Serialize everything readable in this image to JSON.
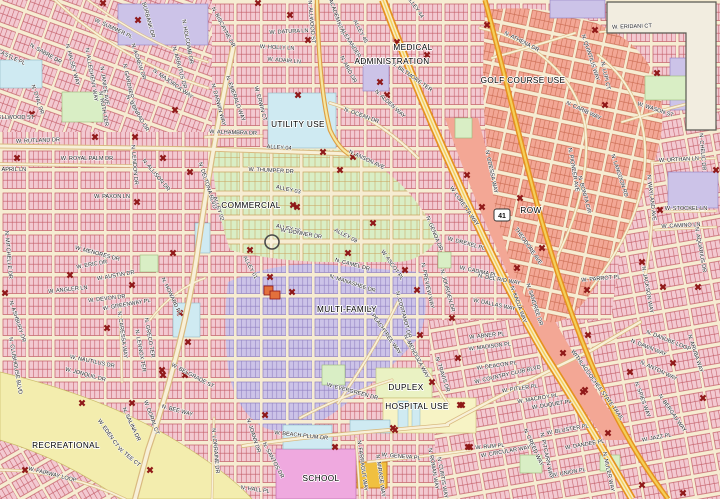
{
  "map": {
    "colors": {
      "parcel_pink": "#f3c9d1",
      "parcel_outline": "#c25b66",
      "street_cream": "#f6ecd2",
      "street_casing": "#d9ba80",
      "salmon": "#f3a795",
      "lavender": "#ccc3e8",
      "commercial_green": "#d9eec5",
      "utility_blue": "#cfeaf2",
      "recreation_yellow": "#f3edae",
      "school_magenta": "#efa9df",
      "hospital_yellow": "#f7f3c5",
      "duplex_green": "#eaf2c3",
      "nodata_beige": "#f2ede0",
      "highway_orange": "#e6921f",
      "highway_core": "#f8ecc0",
      "trail_core": "#f3cf5a",
      "marker_red": "#8f1818"
    },
    "highway_shield": {
      "number": "41"
    },
    "zone_labels": [
      {
        "text": "MEDICAL",
        "x": 413,
        "y": 50
      },
      {
        "text": "ADMINISTRATION",
        "x": 392,
        "y": 64
      },
      {
        "text": "GOLF COURSE USE",
        "x": 523,
        "y": 83
      },
      {
        "text": "UTILITY USE",
        "x": 298,
        "y": 127
      },
      {
        "text": "COMMERCIAL",
        "x": 251,
        "y": 208
      },
      {
        "text": "ROW",
        "x": 531,
        "y": 213
      },
      {
        "text": "MULTI-FAMILY",
        "x": 347,
        "y": 312
      },
      {
        "text": "DUPLEX",
        "x": 406,
        "y": 390
      },
      {
        "text": "HOSPITAL USE",
        "x": 417,
        "y": 409
      },
      {
        "text": "SCHOOL",
        "x": 321,
        "y": 481
      },
      {
        "text": "RECREATIONAL",
        "x": 66,
        "y": 448
      }
    ],
    "street_labels": [
      {
        "text": "W. DATURA LN",
        "x": 289,
        "y": 33,
        "angle": -3
      },
      {
        "text": "W. HOLLY LN",
        "x": 277,
        "y": 49,
        "angle": 3
      },
      {
        "text": "W. ADAIR LN",
        "x": 284,
        "y": 62,
        "angle": 5
      },
      {
        "text": "N. BISCAYNE DR",
        "x": 222,
        "y": 28,
        "angle": 62
      },
      {
        "text": "N. ALLWOOD ST",
        "x": 310,
        "y": 22,
        "angle": 85
      },
      {
        "text": "N. ACADEMY DR",
        "x": 334,
        "y": 14,
        "angle": 70
      },
      {
        "text": "N. ALEXANDER DR",
        "x": 350,
        "y": 45,
        "angle": 58
      },
      {
        "text": "ALLEY 45",
        "x": 359,
        "y": 32,
        "angle": 62
      },
      {
        "text": "N. ABID DR",
        "x": 347,
        "y": 70,
        "angle": 62
      },
      {
        "text": "N. BILTMORE TER",
        "x": 411,
        "y": 78,
        "angle": 35
      },
      {
        "text": "N. ALDEN WAY",
        "x": 389,
        "y": 105,
        "angle": 42
      },
      {
        "text": "ALLEY 44",
        "x": 414,
        "y": 8,
        "angle": 55
      },
      {
        "text": "W. ERIDANI CT",
        "x": 632,
        "y": 28,
        "angle": -2
      },
      {
        "text": "N. ATHENA DR",
        "x": 521,
        "y": 43,
        "angle": 27
      },
      {
        "text": "N. QUINTILIS WAY",
        "x": 589,
        "y": 58,
        "angle": 72
      },
      {
        "text": "N. LUPI CT",
        "x": 604,
        "y": 76,
        "angle": 78
      },
      {
        "text": "N. CARIB WAY",
        "x": 583,
        "y": 112,
        "angle": 25
      },
      {
        "text": "W. WASON ST",
        "x": 655,
        "y": 111,
        "angle": 18
      },
      {
        "text": "W. URTHAN LN",
        "x": 679,
        "y": 161,
        "angle": -3
      },
      {
        "text": "N. CHELIC DR",
        "x": 701,
        "y": 152,
        "angle": 85
      },
      {
        "text": "N. LANGDON RD",
        "x": 618,
        "y": 176,
        "angle": 72
      },
      {
        "text": "N. WAYLAND AVE",
        "x": 650,
        "y": 198,
        "angle": 83
      },
      {
        "text": "W. STOCKEL LN",
        "x": 686,
        "y": 210,
        "angle": 0
      },
      {
        "text": "W. CAMINO LN",
        "x": 681,
        "y": 227,
        "angle": -3
      },
      {
        "text": "N. BONITA CIR",
        "x": 583,
        "y": 195,
        "angle": 75
      },
      {
        "text": "N. PIONEER AVE",
        "x": 572,
        "y": 170,
        "angle": 80
      },
      {
        "text": "N. ODESSA WAY",
        "x": 490,
        "y": 172,
        "angle": 78
      },
      {
        "text": "THEODORE AVE",
        "x": 527,
        "y": 247,
        "angle": 55
      },
      {
        "text": "W. LORETTA WAY",
        "x": 463,
        "y": 207,
        "angle": 55
      },
      {
        "text": "N. GENOA DR",
        "x": 433,
        "y": 234,
        "angle": 68
      },
      {
        "text": "W. DREXEL PL",
        "x": 466,
        "y": 245,
        "angle": 15
      },
      {
        "text": "W. CADIMA PL",
        "x": 478,
        "y": 273,
        "angle": 12
      },
      {
        "text": "N. DEL RIO WAY",
        "x": 499,
        "y": 281,
        "angle": 10
      },
      {
        "text": "W. DALLAS WAY",
        "x": 494,
        "y": 306,
        "angle": 12
      },
      {
        "text": "N. SANDREE DR",
        "x": 533,
        "y": 305,
        "angle": 72
      },
      {
        "text": "N. KADJA WAY",
        "x": 517,
        "y": 305,
        "angle": 70
      },
      {
        "text": "W. PARROT PL",
        "x": 601,
        "y": 280,
        "angle": -5
      },
      {
        "text": "N. JACKSON WAY",
        "x": 646,
        "y": 290,
        "angle": 80
      },
      {
        "text": "N. AQUARIUS DR",
        "x": 699,
        "y": 250,
        "angle": 80
      },
      {
        "text": "W. RUTLAND DR",
        "x": 38,
        "y": 142,
        "angle": -2
      },
      {
        "text": "W. ROYAL PALM DR",
        "x": 87,
        "y": 160,
        "angle": 0
      },
      {
        "text": "W. APRIL LN",
        "x": 10,
        "y": 171,
        "angle": 0
      },
      {
        "text": "W. PAXON LN",
        "x": 112,
        "y": 198,
        "angle": 0
      },
      {
        "text": "N. LENDON DR",
        "x": 133,
        "y": 165,
        "angle": 85
      },
      {
        "text": "N. ALLISON DR",
        "x": 155,
        "y": 176,
        "angle": 50
      },
      {
        "text": "N. MITCHELLE DR",
        "x": 7,
        "y": 255,
        "angle": 85
      },
      {
        "text": "W. MENORES DR",
        "x": 97,
        "y": 255,
        "angle": 15
      },
      {
        "text": "N. DELTONA BLVD",
        "x": 206,
        "y": 186,
        "angle": 72
      },
      {
        "text": "ALLEY 02",
        "x": 217,
        "y": 209,
        "angle": 72
      },
      {
        "text": "ALLEY 01",
        "x": 249,
        "y": 268,
        "angle": 62
      },
      {
        "text": "W. ALHAMBRA DR",
        "x": 233,
        "y": 134,
        "angle": 2
      },
      {
        "text": "ALLEY 04",
        "x": 279,
        "y": 149,
        "angle": 4
      },
      {
        "text": "W. ERWIN CT",
        "x": 259,
        "y": 104,
        "angle": 75
      },
      {
        "text": "N. DARWIN WAY",
        "x": 217,
        "y": 105,
        "angle": 75
      },
      {
        "text": "N. EMERALD WAY",
        "x": 234,
        "y": 99,
        "angle": 70
      },
      {
        "text": "W. THUMPER DR",
        "x": 271,
        "y": 172,
        "angle": 3
      },
      {
        "text": "ALLEY 03",
        "x": 288,
        "y": 191,
        "angle": 12
      },
      {
        "text": "ALLEY 06",
        "x": 288,
        "y": 230,
        "angle": 12
      },
      {
        "text": "W. DONNER DR",
        "x": 301,
        "y": 235,
        "angle": 10
      },
      {
        "text": "ALLEY 09",
        "x": 345,
        "y": 237,
        "angle": 28
      },
      {
        "text": "N. OCEAN DR",
        "x": 361,
        "y": 117,
        "angle": 20
      },
      {
        "text": "N. ANSON AVE",
        "x": 366,
        "y": 161,
        "angle": 25
      },
      {
        "text": "N. CAMEL DR",
        "x": 352,
        "y": 266,
        "angle": 15
      },
      {
        "text": "N. MANASHEE DR",
        "x": 352,
        "y": 285,
        "angle": 18
      },
      {
        "text": "N. PEACHTREE WAY",
        "x": 383,
        "y": 332,
        "angle": 55
      },
      {
        "text": "W. ASCOT PL",
        "x": 391,
        "y": 266,
        "angle": 55
      },
      {
        "text": "N. CORTAMOT DR",
        "x": 402,
        "y": 315,
        "angle": 75
      },
      {
        "text": "N. PREVIEW WAY",
        "x": 426,
        "y": 286,
        "angle": 78
      },
      {
        "text": "N. JOURDEN DR",
        "x": 446,
        "y": 291,
        "angle": 75
      },
      {
        "text": "W. SUMMER PL",
        "x": 113,
        "y": 30,
        "angle": 25
      },
      {
        "text": "N. HALSEY WAY",
        "x": 71,
        "y": 65,
        "angle": 75
      },
      {
        "text": "N. ALLEGHENY WAY",
        "x": 90,
        "y": 75,
        "angle": 80
      },
      {
        "text": "N. JANICE AVE",
        "x": 103,
        "y": 86,
        "angle": 82
      },
      {
        "text": "N. RUTH TER",
        "x": 102,
        "y": 109,
        "angle": 80
      },
      {
        "text": "N. GARDNER WAY",
        "x": 128,
        "y": 88,
        "angle": 78
      },
      {
        "text": "N. AGNEW DR",
        "x": 137,
        "y": 62,
        "angle": 72
      },
      {
        "text": "N. MAJORCA WAY",
        "x": 172,
        "y": 85,
        "angle": 35
      },
      {
        "text": "N. ARBUTUS DR",
        "x": 178,
        "y": 68,
        "angle": 75
      },
      {
        "text": "N. HOLCOMB DR",
        "x": 186,
        "y": 42,
        "angle": 80
      },
      {
        "text": "N. BURBANK DR",
        "x": 146,
        "y": 17,
        "angle": 75
      },
      {
        "text": "N. SABRE DR",
        "x": 45,
        "y": 55,
        "angle": 30
      },
      {
        "text": "W. CASTLE PL",
        "x": 7,
        "y": 57,
        "angle": 25
      },
      {
        "text": "W. ELLWOOD ST",
        "x": 12,
        "y": 119,
        "angle": 0
      },
      {
        "text": "N. DYAL DR",
        "x": 36,
        "y": 100,
        "angle": 72
      },
      {
        "text": "N. CONRAD DR",
        "x": 136,
        "y": 114,
        "angle": 60
      },
      {
        "text": "W. ERIC DR",
        "x": 92,
        "y": 266,
        "angle": -10
      },
      {
        "text": "W. ANGLER LN",
        "x": 68,
        "y": 291,
        "angle": -6
      },
      {
        "text": "W. AUSTIN DR",
        "x": 116,
        "y": 277,
        "angle": -10
      },
      {
        "text": "W. DEVON DR",
        "x": 107,
        "y": 300,
        "angle": -7
      },
      {
        "text": "W. GREENWAY PL",
        "x": 127,
        "y": 306,
        "angle": -10
      },
      {
        "text": "N. CARESSA WAY",
        "x": 121,
        "y": 335,
        "angle": 82
      },
      {
        "text": "N. LENNOX TER",
        "x": 139,
        "y": 351,
        "angle": 80
      },
      {
        "text": "N. GRECO TER",
        "x": 148,
        "y": 338,
        "angle": 80
      },
      {
        "text": "N. HOWARD PL",
        "x": 170,
        "y": 297,
        "angle": 65
      },
      {
        "text": "W. NAUTILUS DR",
        "x": 92,
        "y": 363,
        "angle": 12
      },
      {
        "text": "W. JONQUIL DR",
        "x": 85,
        "y": 376,
        "angle": 15
      },
      {
        "text": "N. CLUBHOUSE BLVD",
        "x": 14,
        "y": 366,
        "angle": 80
      },
      {
        "text": "N. ASHBURY DR",
        "x": 16,
        "y": 322,
        "angle": 72
      },
      {
        "text": "W. BELGRADE ST",
        "x": 192,
        "y": 377,
        "angle": 28
      },
      {
        "text": "W. FAIRWAY LOOP",
        "x": 52,
        "y": 476,
        "angle": 14
      },
      {
        "text": "W. EDEN CT",
        "x": 107,
        "y": 434,
        "angle": 55
      },
      {
        "text": "N. SALINA DR",
        "x": 130,
        "y": 425,
        "angle": 65
      },
      {
        "text": "W. DORAL CT",
        "x": 150,
        "y": 418,
        "angle": 70
      },
      {
        "text": "N. BEE WAY",
        "x": 177,
        "y": 412,
        "angle": 15
      },
      {
        "text": "W. TEE CT",
        "x": 128,
        "y": 458,
        "angle": 40
      },
      {
        "text": "N. LORRAINE DR",
        "x": 214,
        "y": 451,
        "angle": 85
      },
      {
        "text": "W. BEACH PLUM DR",
        "x": 301,
        "y": 437,
        "angle": 6
      },
      {
        "text": "N. JOANN DR",
        "x": 252,
        "y": 436,
        "angle": 72
      },
      {
        "text": "N. SANTOS DR",
        "x": 272,
        "y": 461,
        "angle": 62
      },
      {
        "text": "N. FARRAGUT WAY",
        "x": 361,
        "y": 466,
        "angle": 82
      },
      {
        "text": "N. MIRAGE WAY",
        "x": 379,
        "y": 476,
        "angle": 82
      },
      {
        "text": "W. GENEVA PL",
        "x": 401,
        "y": 458,
        "angle": 5
      },
      {
        "text": "N. ROMAN WAY",
        "x": 432,
        "y": 469,
        "angle": 80
      },
      {
        "text": "N. CURTIS WAY",
        "x": 441,
        "y": 478,
        "angle": 80
      },
      {
        "text": "N. HALL PL",
        "x": 255,
        "y": 491,
        "angle": 8
      },
      {
        "text": "W. EVERGREEN DR",
        "x": 352,
        "y": 393,
        "angle": 15
      },
      {
        "text": "N. MENDOZA WAY",
        "x": 415,
        "y": 357,
        "angle": 62
      },
      {
        "text": "N. TRAVIS DR",
        "x": 441,
        "y": 375,
        "angle": 72
      },
      {
        "text": "W. ABNER PL",
        "x": 487,
        "y": 337,
        "angle": -6
      },
      {
        "text": "W. MADISON PL",
        "x": 490,
        "y": 348,
        "angle": -7
      },
      {
        "text": "W. DEACON PL",
        "x": 497,
        "y": 367,
        "angle": -8
      },
      {
        "text": "W. COUNTRY CLUB BLVD",
        "x": 508,
        "y": 376,
        "angle": -13
      },
      {
        "text": "W. PITLER PL",
        "x": 520,
        "y": 390,
        "angle": -8
      },
      {
        "text": "W. MACROY PL",
        "x": 538,
        "y": 400,
        "angle": -9
      },
      {
        "text": "W. DUQUET PL",
        "x": 552,
        "y": 406,
        "angle": -9
      },
      {
        "text": "W. RUM PL",
        "x": 490,
        "y": 448,
        "angle": -5
      },
      {
        "text": "W. CIRCULAR WAY",
        "x": 506,
        "y": 453,
        "angle": -10
      },
      {
        "text": "N. CREED WAY",
        "x": 532,
        "y": 448,
        "angle": 65
      },
      {
        "text": "W. BLUSTER PL",
        "x": 568,
        "y": 431,
        "angle": -10
      },
      {
        "text": "W. DANDEE PL",
        "x": 585,
        "y": 446,
        "angle": -10
      },
      {
        "text": "W. UNION PL",
        "x": 569,
        "y": 474,
        "angle": -10
      },
      {
        "text": "N. MULER WAY",
        "x": 607,
        "y": 472,
        "angle": 78
      },
      {
        "text": "N. PITCAIRN WAY",
        "x": 545,
        "y": 456,
        "angle": 78
      },
      {
        "text": "W. JAZZ PL",
        "x": 657,
        "y": 439,
        "angle": -10
      },
      {
        "text": "N. BERGAU WAY",
        "x": 671,
        "y": 414,
        "angle": 55
      },
      {
        "text": "N. SPIES WAY",
        "x": 641,
        "y": 400,
        "angle": 70
      },
      {
        "text": "N. ANTON WAY",
        "x": 658,
        "y": 372,
        "angle": 25
      },
      {
        "text": "N. DAWN WAY",
        "x": 648,
        "y": 349,
        "angle": 22
      },
      {
        "text": "N. DANUBE LOOP",
        "x": 668,
        "y": 342,
        "angle": 22
      },
      {
        "text": "N. ARUBA WAY",
        "x": 694,
        "y": 354,
        "angle": 72
      },
      {
        "text": "WITHLACOOCHEE STATE TRAIL",
        "x": 596,
        "y": 386,
        "angle": 54
      }
    ],
    "markers": [
      [
        103,
        3
      ],
      [
        138,
        20
      ],
      [
        258,
        3
      ],
      [
        290,
        15
      ],
      [
        308,
        40
      ],
      [
        397,
        42
      ],
      [
        427,
        55
      ],
      [
        380,
        82
      ],
      [
        487,
        25
      ],
      [
        595,
        30
      ],
      [
        657,
        73
      ],
      [
        605,
        105
      ],
      [
        298,
        95
      ],
      [
        387,
        95
      ],
      [
        32,
        114
      ],
      [
        175,
        110
      ],
      [
        95,
        137
      ],
      [
        135,
        137
      ],
      [
        17,
        158
      ],
      [
        163,
        158
      ],
      [
        190,
        172
      ],
      [
        137,
        202
      ],
      [
        323,
        152
      ],
      [
        353,
        157
      ],
      [
        340,
        170
      ],
      [
        297,
        207
      ],
      [
        250,
        250
      ],
      [
        270,
        277
      ],
      [
        293,
        205
      ],
      [
        373,
        223
      ],
      [
        348,
        253
      ],
      [
        292,
        292
      ],
      [
        405,
        270
      ],
      [
        417,
        290
      ],
      [
        452,
        318
      ],
      [
        467,
        175
      ],
      [
        520,
        198
      ],
      [
        482,
        207
      ],
      [
        517,
        268
      ],
      [
        542,
        248
      ],
      [
        587,
        290
      ],
      [
        642,
        262
      ],
      [
        663,
        287
      ],
      [
        660,
        210
      ],
      [
        698,
        287
      ],
      [
        716,
        170
      ],
      [
        70,
        275
      ],
      [
        132,
        285
      ],
      [
        107,
        328
      ],
      [
        180,
        313
      ],
      [
        188,
        342
      ],
      [
        162,
        370
      ],
      [
        82,
        403
      ],
      [
        132,
        403
      ],
      [
        163,
        375
      ],
      [
        185,
        375
      ],
      [
        25,
        470
      ],
      [
        150,
        470
      ],
      [
        265,
        415
      ],
      [
        335,
        447
      ],
      [
        395,
        430
      ],
      [
        462,
        405
      ],
      [
        470,
        447
      ],
      [
        420,
        335
      ],
      [
        458,
        358
      ],
      [
        563,
        353
      ],
      [
        432,
        382
      ],
      [
        460,
        405
      ],
      [
        583,
        392
      ],
      [
        393,
        428
      ],
      [
        468,
        447
      ],
      [
        588,
        335
      ],
      [
        630,
        372
      ],
      [
        673,
        363
      ],
      [
        585,
        390
      ],
      [
        703,
        398
      ],
      [
        608,
        433
      ],
      [
        642,
        485
      ],
      [
        683,
        493
      ],
      [
        173,
        253
      ],
      [
        5,
        293
      ]
    ]
  }
}
